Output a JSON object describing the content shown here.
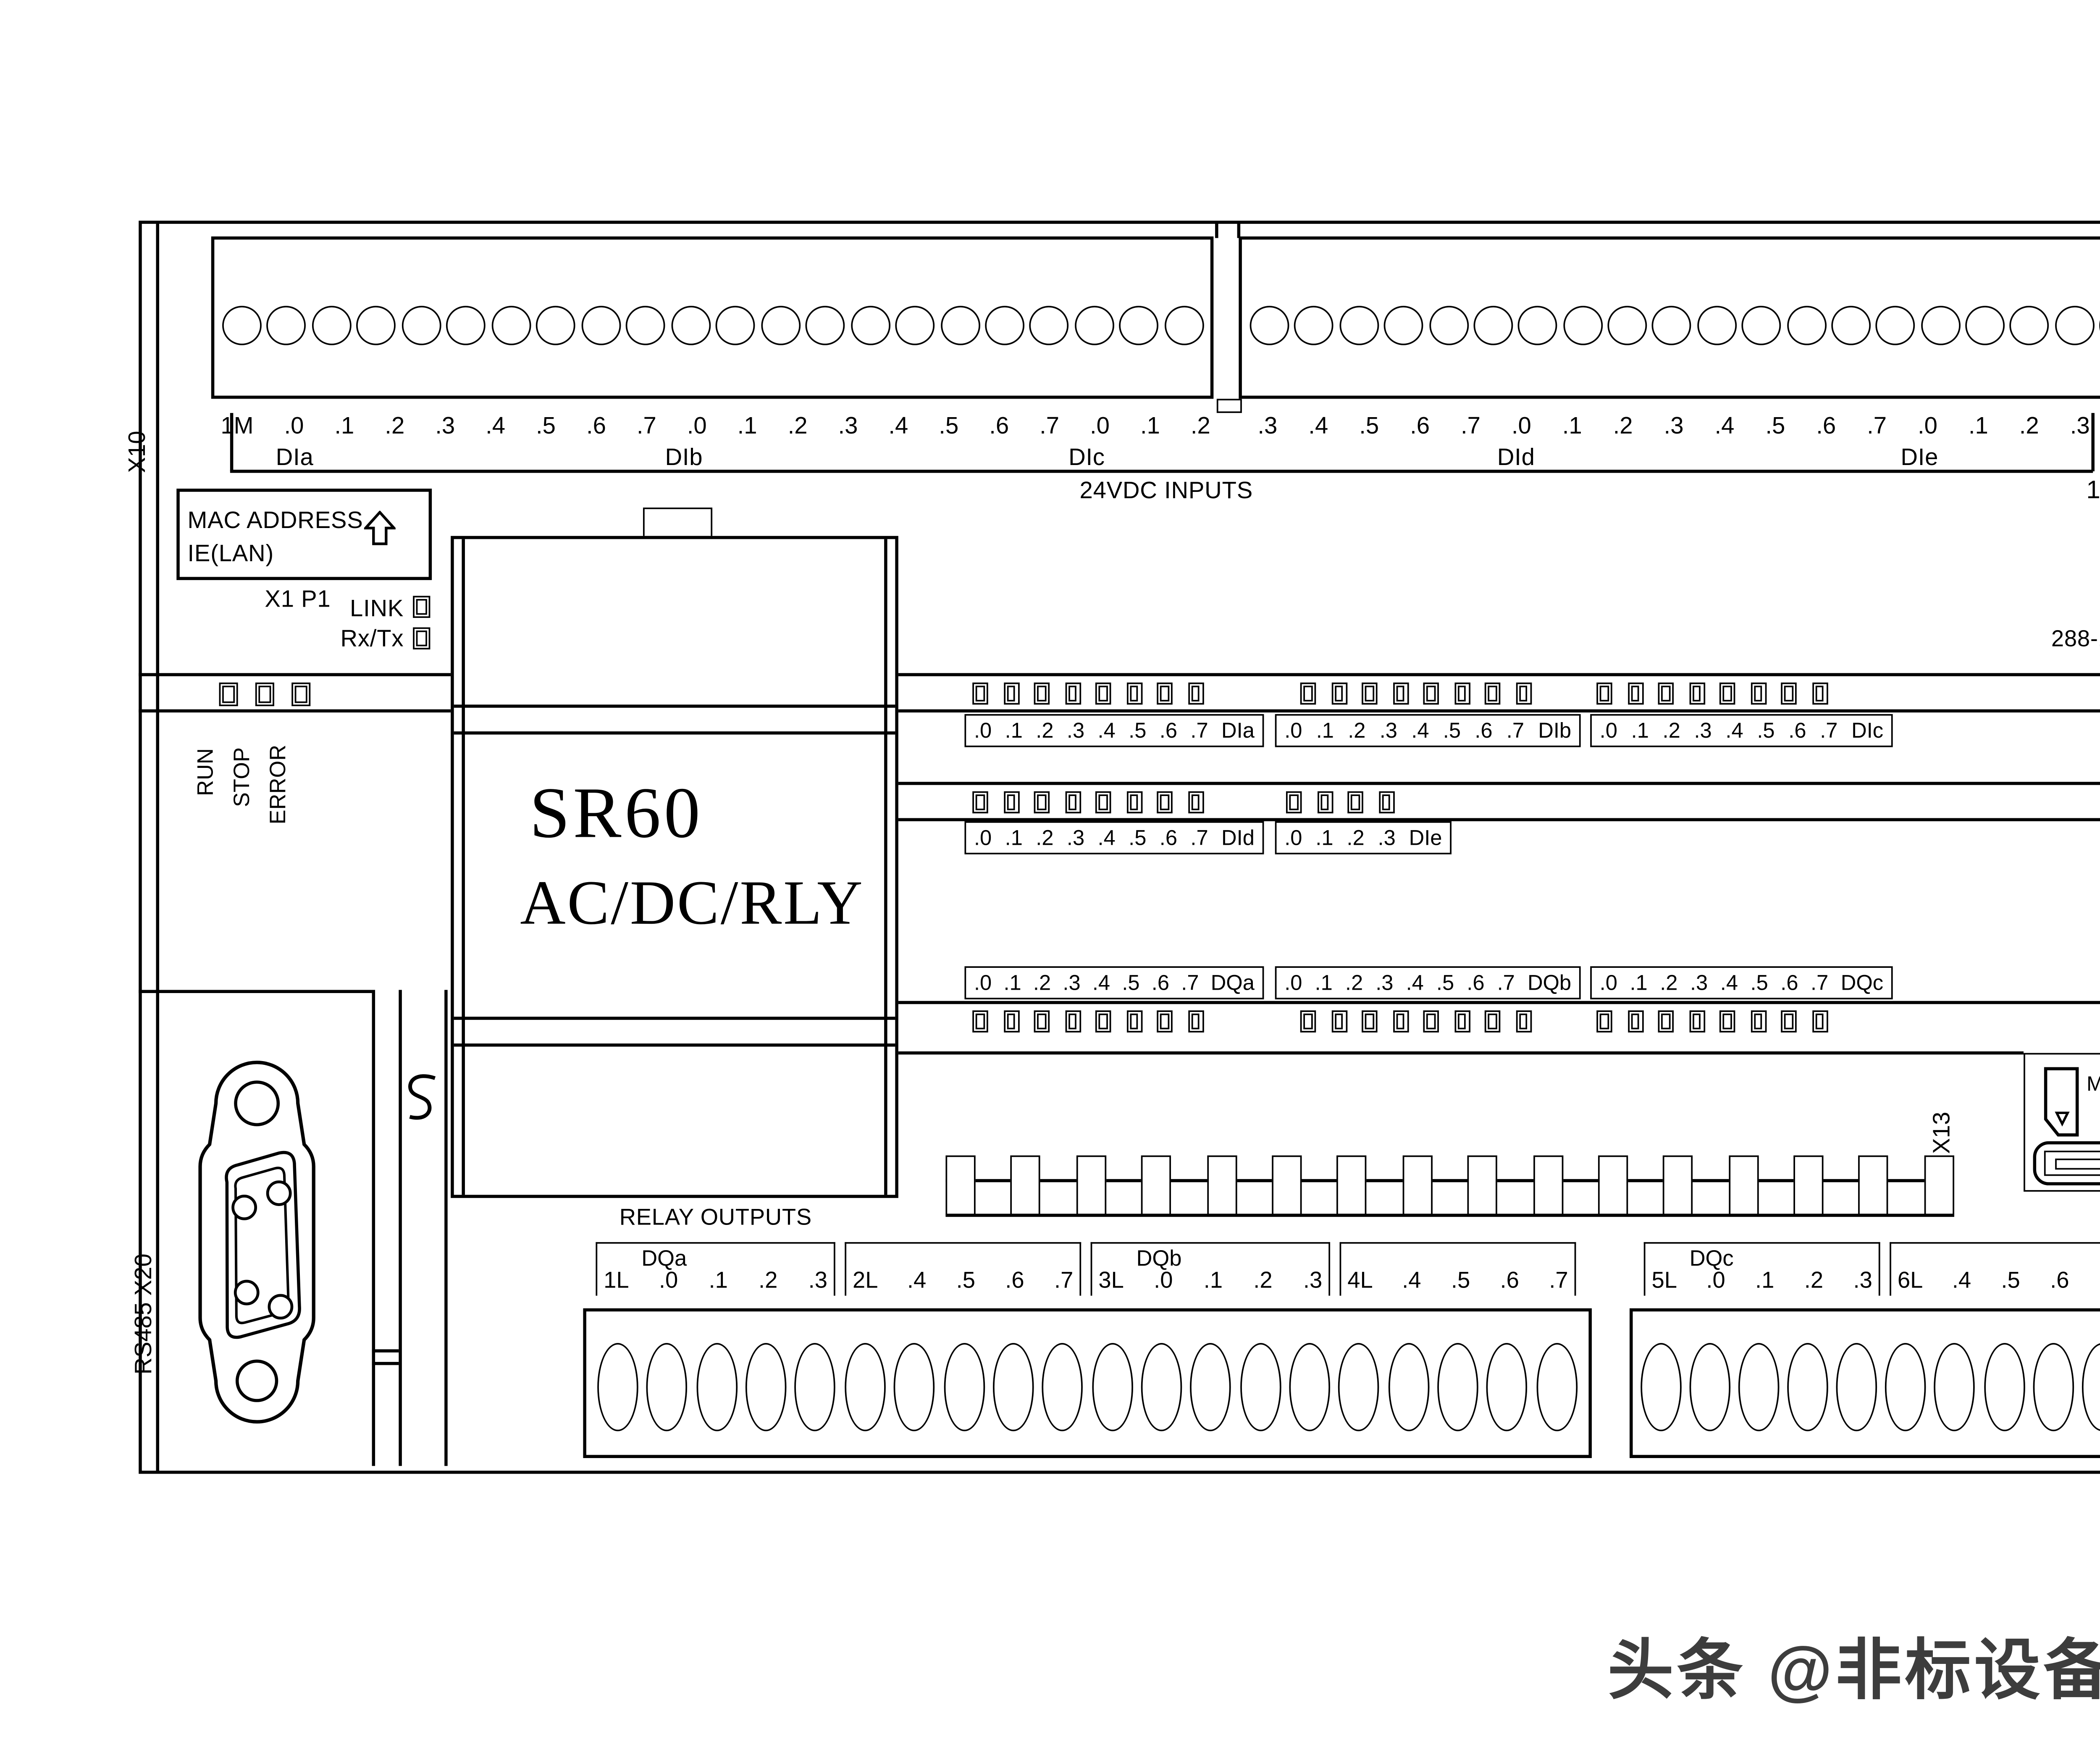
{
  "colors": {
    "line": "#000000",
    "background": "#ffffff",
    "watermark": "#3d3d3d"
  },
  "device": {
    "model": "SR60",
    "power_type": "AC/DC/RLY",
    "cpu_label": "CPU SR60",
    "order_number": "288-1SR60-0AA0"
  },
  "top": {
    "x10": "X10",
    "x11": "X11",
    "left_terminal_labels": [
      "1M",
      ".0",
      ".1",
      ".2",
      ".3",
      ".4",
      ".5",
      ".6",
      ".7",
      ".0",
      ".1",
      ".2",
      ".3",
      ".4",
      ".5",
      ".6",
      ".7",
      ".0",
      ".1",
      ".2"
    ],
    "right_terminal_labels": [
      ".3",
      ".4",
      ".5",
      ".6",
      ".7",
      ".0",
      ".1",
      ".2",
      ".3",
      ".4",
      ".5",
      ".6",
      ".7",
      ".0",
      ".1",
      ".2",
      ".3"
    ],
    "power_terminal_labels": [
      "L1",
      "N"
    ],
    "group_dia": "DIa",
    "group_dib": "DIb",
    "group_dic": "DIc",
    "group_did": "DId",
    "group_die": "DIe",
    "inputs_caption": "24VDC INPUTS",
    "power_caption": "120-240VAC"
  },
  "ethernet": {
    "mac_line1": "MAC ADDRESS",
    "mac_line2": "IE(LAN)",
    "port": "X1 P1",
    "link_label": "LINK",
    "rxtx_label": "Rx/Tx"
  },
  "status_leds": [
    "RUN",
    "STOP",
    "ERROR"
  ],
  "input_led_rows": [
    {
      "labels": [
        ".0",
        ".1",
        ".2",
        ".3",
        ".4",
        ".5",
        ".6",
        ".7",
        "DIa"
      ]
    },
    {
      "labels": [
        ".0",
        ".1",
        ".2",
        ".3",
        ".4",
        ".5",
        ".6",
        ".7",
        "DIb"
      ]
    },
    {
      "labels": [
        ".0",
        ".1",
        ".2",
        ".3",
        ".4",
        ".5",
        ".6",
        ".7",
        "DIc"
      ]
    },
    {
      "labels": [
        ".0",
        ".1",
        ".2",
        ".3",
        ".4",
        ".5",
        ".6",
        ".7",
        "DId"
      ]
    },
    {
      "labels": [
        ".0",
        ".1",
        ".2",
        ".3",
        "DIe"
      ]
    }
  ],
  "output_led_rows": [
    {
      "labels": [
        ".0",
        ".1",
        ".2",
        ".3",
        ".4",
        ".5",
        ".6",
        ".7",
        "DQa"
      ]
    },
    {
      "labels": [
        ".0",
        ".1",
        ".2",
        ".3",
        ".4",
        ".5",
        ".6",
        ".7",
        "DQb"
      ]
    },
    {
      "labels": [
        ".0",
        ".1",
        ".2",
        ".3",
        ".4",
        ".5",
        ".6",
        ".7",
        "DQc"
      ]
    }
  ],
  "bottom": {
    "relay_caption": "RELAY OUTPUTS",
    "groups": [
      {
        "name": "DQa",
        "terminals": [
          "1L",
          ".0",
          ".1",
          ".2",
          ".3"
        ]
      },
      {
        "name": "",
        "terminals": [
          "2L",
          ".4",
          ".5",
          ".6",
          ".7"
        ]
      },
      {
        "name": "DQb",
        "terminals": [
          "3L",
          ".0",
          ".1",
          ".2",
          ".3"
        ]
      },
      {
        "name": "",
        "terminals": [
          "4L",
          ".4",
          ".5",
          ".6",
          ".7"
        ]
      },
      {
        "name": "DQc",
        "terminals": [
          "5L",
          ".0",
          ".1",
          ".2",
          ".3"
        ]
      },
      {
        "name": "",
        "terminals": [
          "6L",
          ".4",
          ".5",
          ".6",
          ".7"
        ]
      }
    ],
    "sensor_power": {
      "caption": "24VDC",
      "terminals": [
        "L+",
        "M"
      ]
    }
  },
  "side": {
    "rs485_label": "RS485  X20",
    "x12": "X12",
    "x13": "X13"
  },
  "memory_card": {
    "line1": "Micro-SD",
    "line2": "X50"
  },
  "watermark": "头条 @非标设备自动化设计",
  "counts": {
    "status_leds": 3,
    "led8": 8,
    "led4": 4,
    "top_terminals_left": 22,
    "top_terminals_right": 22,
    "bottom_terminals_left": 20,
    "bottom_terminals_right": 12,
    "bus_teeth": 16
  }
}
